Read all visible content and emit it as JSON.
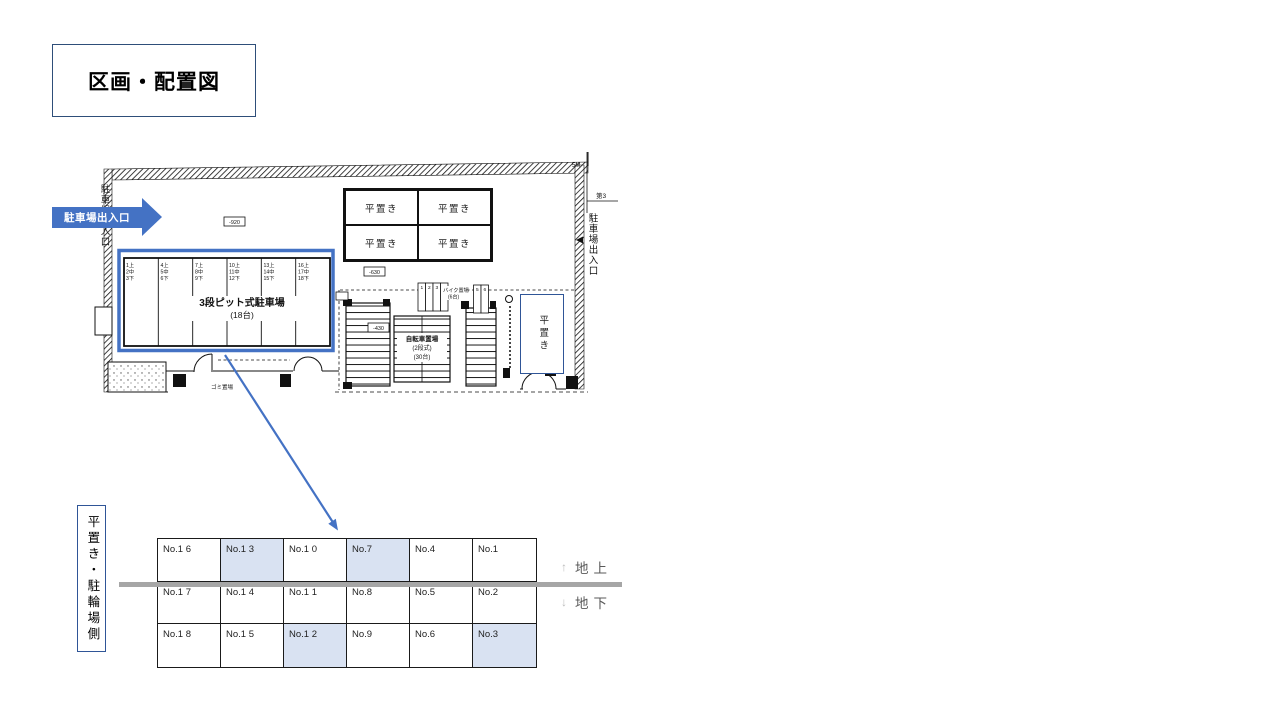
{
  "title": "区画・配置図",
  "plan": {
    "entrance_label": "駐車場出入口",
    "left_exit_label": "駐車場出入口",
    "right_exit_label": "駐車場出入口",
    "boundary_label": "第3",
    "scale_note": "5M",
    "flat_spots": [
      "平置き",
      "平置き",
      "平置き",
      "平置き"
    ],
    "flat_right": "平置き",
    "pit": {
      "title": "3段ピット式駐車場",
      "capacity": "(18台)",
      "bays": [
        [
          "1上",
          "2中",
          "3下"
        ],
        [
          "4上",
          "5中",
          "6下"
        ],
        [
          "7上",
          "8中",
          "9下"
        ],
        [
          "10上",
          "11中",
          "12下"
        ],
        [
          "13上",
          "14中",
          "15下"
        ],
        [
          "16上",
          "17中",
          "18下"
        ]
      ]
    },
    "bike": {
      "label": "バイク置場",
      "capacity": "(6台)",
      "slots": [
        "1",
        "2",
        "3",
        "4",
        "5",
        "6"
      ]
    },
    "bicycle": [
      "自転車置場",
      "(2段式)",
      "(30台)"
    ],
    "garbage_label": "ゴミ置場",
    "elevations": [
      "-920",
      "-630",
      "-430"
    ]
  },
  "legend": {
    "label": "平置き・駐輪場側"
  },
  "levels": {
    "up_symbol": "↑",
    "ground": "地上",
    "down_symbol": "↓",
    "underground": "地下"
  },
  "table": {
    "rows": [
      [
        {
          "label": "No.1 6",
          "highlight": false
        },
        {
          "label": "No.1 3",
          "highlight": true
        },
        {
          "label": "No.1 0",
          "highlight": false
        },
        {
          "label": "No.7",
          "highlight": true
        },
        {
          "label": "No.4",
          "highlight": false
        },
        {
          "label": "No.1",
          "highlight": false
        }
      ],
      [
        {
          "label": "No.1 7",
          "highlight": false
        },
        {
          "label": "No.1 4",
          "highlight": false
        },
        {
          "label": "No.1 1",
          "highlight": false
        },
        {
          "label": "No.8",
          "highlight": false
        },
        {
          "label": "No.5",
          "highlight": false
        },
        {
          "label": "No.2",
          "highlight": false
        }
      ],
      [
        {
          "label": "No.1 8",
          "highlight": false
        },
        {
          "label": "No.1 5",
          "highlight": false
        },
        {
          "label": "No.1 2",
          "highlight": true
        },
        {
          "label": "No.9",
          "highlight": false
        },
        {
          "label": "No.6",
          "highlight": false
        },
        {
          "label": "No.3",
          "highlight": true
        }
      ]
    ]
  },
  "colors": {
    "accent": "#4472C4",
    "table_highlight": "#D9E2F2",
    "level_line": "#A6A6A6"
  }
}
